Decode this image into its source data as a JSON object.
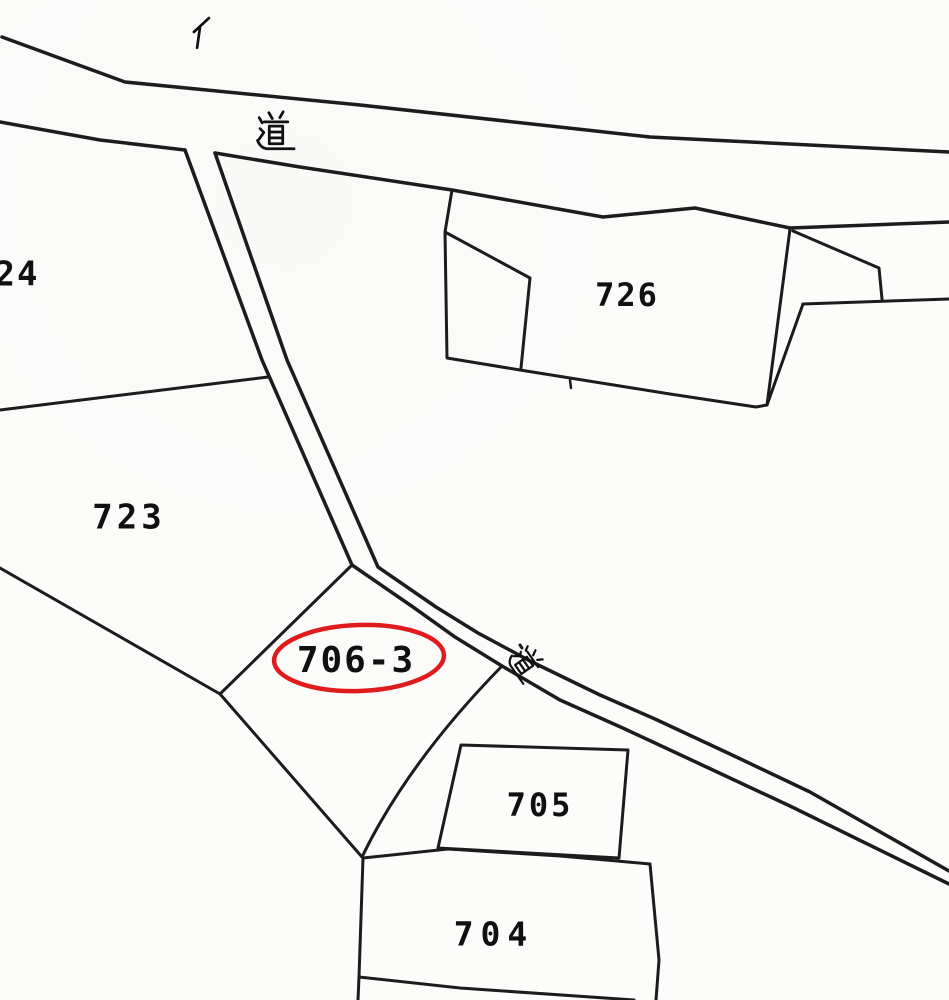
{
  "document": {
    "type": "cadastral-map-scan",
    "background_color": "#fcfcfb",
    "line_color": "#1c1c1c",
    "text_color": "#101010",
    "highlight_color": "#e01b1b"
  },
  "parcel_labels": [
    {
      "name": "parcel-label-724",
      "text": "24",
      "x": 17,
      "y": 276,
      "size": 34,
      "ls": 2
    },
    {
      "name": "parcel-label-723",
      "text": "723",
      "x": 129,
      "y": 519,
      "size": 34,
      "ls": 4
    },
    {
      "name": "parcel-label-726",
      "text": "726",
      "x": 627,
      "y": 297,
      "size": 32,
      "ls": 2
    },
    {
      "name": "parcel-label-706-3",
      "text": "706-3",
      "x": 356,
      "y": 662,
      "size": 36,
      "ls": 2
    },
    {
      "name": "parcel-label-705",
      "text": "705",
      "x": 540,
      "y": 807,
      "size": 32,
      "ls": 3
    },
    {
      "name": "parcel-label-704",
      "text": "704",
      "x": 494,
      "y": 936,
      "size": 33,
      "ls": 7
    }
  ],
  "kanji_labels": [
    {
      "name": "road-label-top",
      "char": "道",
      "x": 276,
      "y": 132,
      "size": 42,
      "rotate": 0
    },
    {
      "name": "road-label-middle",
      "char": "道",
      "x": 526,
      "y": 664,
      "size": 34,
      "rotate": 55
    },
    {
      "name": "marker-label-i",
      "char": "イ",
      "x": 201,
      "y": 33,
      "size": 36,
      "rotate": 8
    }
  ],
  "highlight_ellipse": {
    "name": "highlight-ellipse-706-3",
    "cx": 359,
    "cy": 658,
    "rx": 85,
    "ry": 33,
    "stroke_width": 4.5,
    "tilt": -2
  },
  "boundary_paths": [
    {
      "name": "road-main-top-edge",
      "d": "M 2 37 L 125 82 L 360 105 L 650 137 L 949 152",
      "w": 3.5
    },
    {
      "name": "road-main-bottom-edge-west",
      "d": "M 0 122 L 100 140 L 185 150",
      "w": 3.5
    },
    {
      "name": "road-main-bottom-edge-east",
      "d": "M 215 153 L 300 167 L 452 190 L 603 217 L 695 208 L 790 228 L 949 222",
      "w": 3.5
    },
    {
      "name": "branch-road-west-edge",
      "d": "M 185 150 L 262 360 L 352 565 L 413 607 L 455 637 L 502 666 L 560 700 L 625 729 L 700 764 L 790 806 L 949 884",
      "w": 3.5
    },
    {
      "name": "branch-road-east-edge",
      "d": "M 215 153 L 287 360 L 378 567 L 436 607 L 478 633 L 530 661 L 600 695 L 655 719 L 730 754 L 810 792 L 949 871",
      "w": 3.5
    },
    {
      "name": "boundary-724-723",
      "d": "M 0 410 L 268 377",
      "w": 3
    },
    {
      "name": "boundary-723-south",
      "d": "M 0 568 L 220 694",
      "w": 3
    },
    {
      "name": "parcel-706-3-northwest-edge",
      "d": "M 352 565 L 220 694",
      "w": 3
    },
    {
      "name": "parcel-706-3-southwest-edge",
      "d": "M 220 694 L 362 857",
      "w": 3
    },
    {
      "name": "parcel-706-3-east-edge",
      "d": "M 502 666 Q 408 762 362 857",
      "w": 3
    },
    {
      "name": "parcel-726-west-south-east-edges",
      "d": "M 452 190 L 445 232 L 447 358 L 520 370 L 670 394 L 756 407 L 767 405 L 790 229",
      "w": 3
    },
    {
      "name": "parcel-726-inner-boundary",
      "d": "M 445 232 L 530 278 L 521 368",
      "w": 3
    },
    {
      "name": "boundary-east-diagonal",
      "d": "M 803 304 L 767 405",
      "w": 3
    },
    {
      "name": "boundary-east-horizontal",
      "d": "M 803 304 L 949 299",
      "w": 3
    },
    {
      "name": "boundary-east-wedge",
      "d": "M 793 231 L 879 268 L 882 299",
      "w": 3
    },
    {
      "name": "parcel-705-outline",
      "d": "M 461 745 L 628 750 L 619 858 L 438 848 Z",
      "w": 3
    },
    {
      "name": "parcel-704-north-edge",
      "d": "M 363 858 L 448 849 L 560 856 L 617 861 L 650 864",
      "w": 3
    },
    {
      "name": "parcel-704-east-edge",
      "d": "M 650 864 L 659 960 L 656 1000",
      "w": 3
    },
    {
      "name": "parcel-704-west-edge",
      "d": "M 363 858 L 359 977 L 358 1000",
      "w": 3
    },
    {
      "name": "boundary-south",
      "d": "M 359 977 L 460 988 L 634 1000",
      "w": 3
    },
    {
      "name": "survey-tick",
      "d": "M 570 380 L 571 388",
      "w": 2.5
    },
    {
      "name": "road-dot",
      "d": "M 520 645 L 522 648",
      "w": 3
    }
  ]
}
